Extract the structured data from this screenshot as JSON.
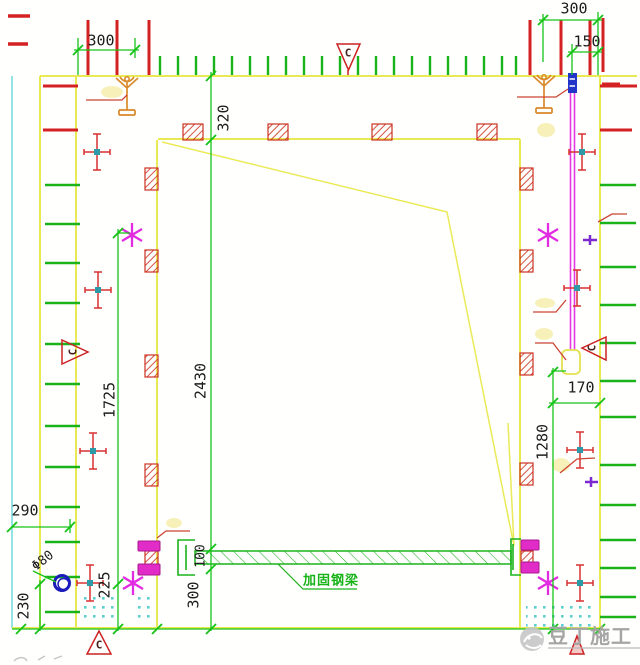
{
  "drawing": {
    "dimensions": {
      "top_left_width": "300",
      "top_right_width": "300",
      "top_right_inset": "150",
      "lintel_height": "320",
      "opening_height": "2430",
      "left_upper_height": "1725",
      "right_lower_height": "1280",
      "anchor_offset": "170",
      "left_margin": "290",
      "anchor_below": "230",
      "anchor_above": "225",
      "beam_to_base": "300",
      "beam_depth": "100",
      "hole_diameter": "Φ80"
    },
    "labels": {
      "beam": "加固钢梁",
      "section_mark": "C"
    },
    "watermark": {
      "text": "豆丁施工"
    },
    "colors": {
      "formwork_yellow": "#e9e954",
      "dimension_green": "#1db51d",
      "rebar_red": "#d42222",
      "tie_magenta": "#e428e4",
      "guide_cyan": "#7adde0",
      "hatch_red": "#cc3322",
      "prop_orange": "#d98a2b",
      "anchor_blue": "#1b1bbb",
      "watermark_gray": "#a5a5a5"
    }
  }
}
